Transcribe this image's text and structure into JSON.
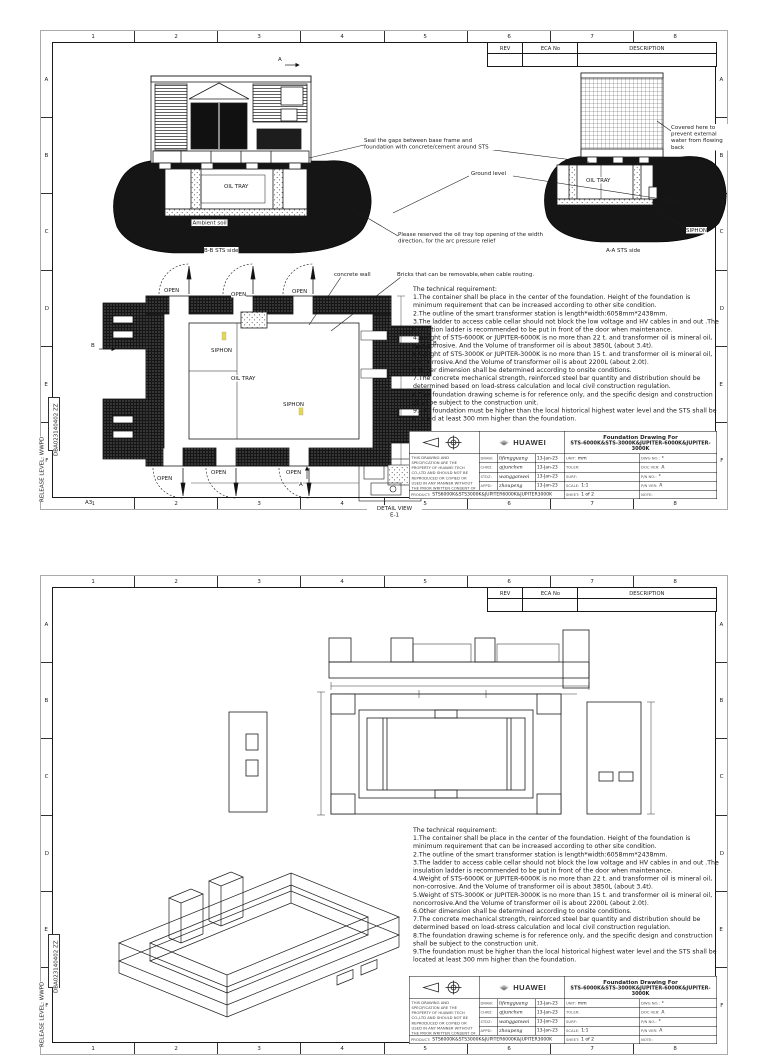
{
  "sheet": {
    "cols": [
      "1",
      "2",
      "3",
      "4",
      "5",
      "6",
      "7",
      "8"
    ],
    "rows": [
      "A",
      "B",
      "C",
      "D",
      "E",
      "F"
    ],
    "size_label": "A3",
    "rev": {
      "rev": "REV",
      "eca": "ECA No",
      "desc": "DESCRIPTION"
    },
    "release_label": "RELEASE LEVEL:",
    "release_value": "WWPD",
    "drawing_no": "DBA023140402 ZZ"
  },
  "tech": {
    "title": "The technical requirement:",
    "items": [
      "1.The container shall be place in the center of the foundation. Height of the foundation is minimum requirement that can be increased according to other site condition.",
      "2.The outline of the smart transformer station is length*width:6058mm*2438mm.",
      "3.The ladder to access cable cellar should not block the low voltage and HV cables in and out .The insulation ladder is recommended to be put in front of the door when maintenance.",
      "4.Weight of STS-6000K or JUPITER-6000K is no more than 22 t. and transformer oil is mineral oil, non-corrosive. And the Volume of transformer oil is about 3850L (about 3.4t).",
      "5.Weight of STS-3000K or JUPITER-3000K is no more than 15 t. and transformer oil is mineral oil, noncorrosive.And the Volume of transformer oil is about 2200L (about 2.0t).",
      "6.Other dimension shall be determined according to onsite conditions.",
      "7.The concrete mechanical strength, reinforced steel bar quantity and distribution should be determined based on load-stress calculation and local civil construction regulation.",
      "8.The foundation drawing scheme is for reference only, and the specific design and construction shall be subject to the construction unit.",
      "9.The foundation must be higher than the local historical highest water level and the STS shall be located at least 300 mm higher than the foundation."
    ]
  },
  "sheet1": {
    "labels": {
      "seal": "Seal the gaps between base frame and foundation with concrete/cement around STS",
      "ground": "Ground level",
      "reserved": "Please reserved the oil tray top opening of the width direction, for the arc pressure relief",
      "covered": "Covered here to prevent external water from flowing back",
      "ambient": "Ambient soil",
      "bb": "B-B STS side",
      "aa": "A-A STS side",
      "oil_tray": "OIL TRAY",
      "siphon": "SIPHON",
      "open": "OPEN",
      "concrete": "concrete wall",
      "bricks": "Bricks that can be removable,when cable routing.",
      "detail1": "DETAIL VIEW",
      "detail2": "E-1",
      "marker_a": "A",
      "marker_b": "B"
    }
  },
  "title_block": {
    "company": "HUAWEI",
    "title1": "Foundation Drawing For",
    "title2": "STS-6000K&STS-3000K&JUPITER-6000K&JUPITER-3000K",
    "legal": "THIS DRAWING AND SPECIFICATION ARE THE PROPERTY OF HUAWEI TECH CO.,LTD AND SHOULD NOT BE REPRODUCED OR COPIED OR USED IN ANY MANNER WITHOUT THE PRIOR WRITTEN CONSENT OF HUAWEI TECH CO.,LTD.",
    "sig_labels": [
      "DRAW:",
      "CHKD:",
      "STDZ:",
      "APPD:"
    ],
    "sig_names": [
      "lifengguang",
      "qijunchen",
      "wangganwei",
      "zhoupeng"
    ],
    "sig_dates": [
      "13-Jan-23",
      "13-Jan-23",
      "13-Jan-23",
      "13-Jan-23"
    ],
    "product_label": "PRODUCT:",
    "product_value": "STS6000K&STS3000K&JUPITER6000K&JUPITER3000K",
    "unit_label": "UNIT:",
    "unit_value": "mm",
    "toler_label": "TOLER:",
    "surf_label": "SURF:",
    "scale_label": "SCALE:",
    "scale_value": "1:1",
    "sheet_label": "SHEET:",
    "sheet_value": "1 of 2",
    "dwg_label": "DWG NO.:",
    "dwg_value": "*",
    "ver_label": "DOC VER:",
    "ver_value": "A",
    "pn_label": "P/N NO.:",
    "pn_value": "*",
    "pnver_label": "P/N VER:",
    "pnver_value": "A",
    "note_label": "NOTE:"
  }
}
